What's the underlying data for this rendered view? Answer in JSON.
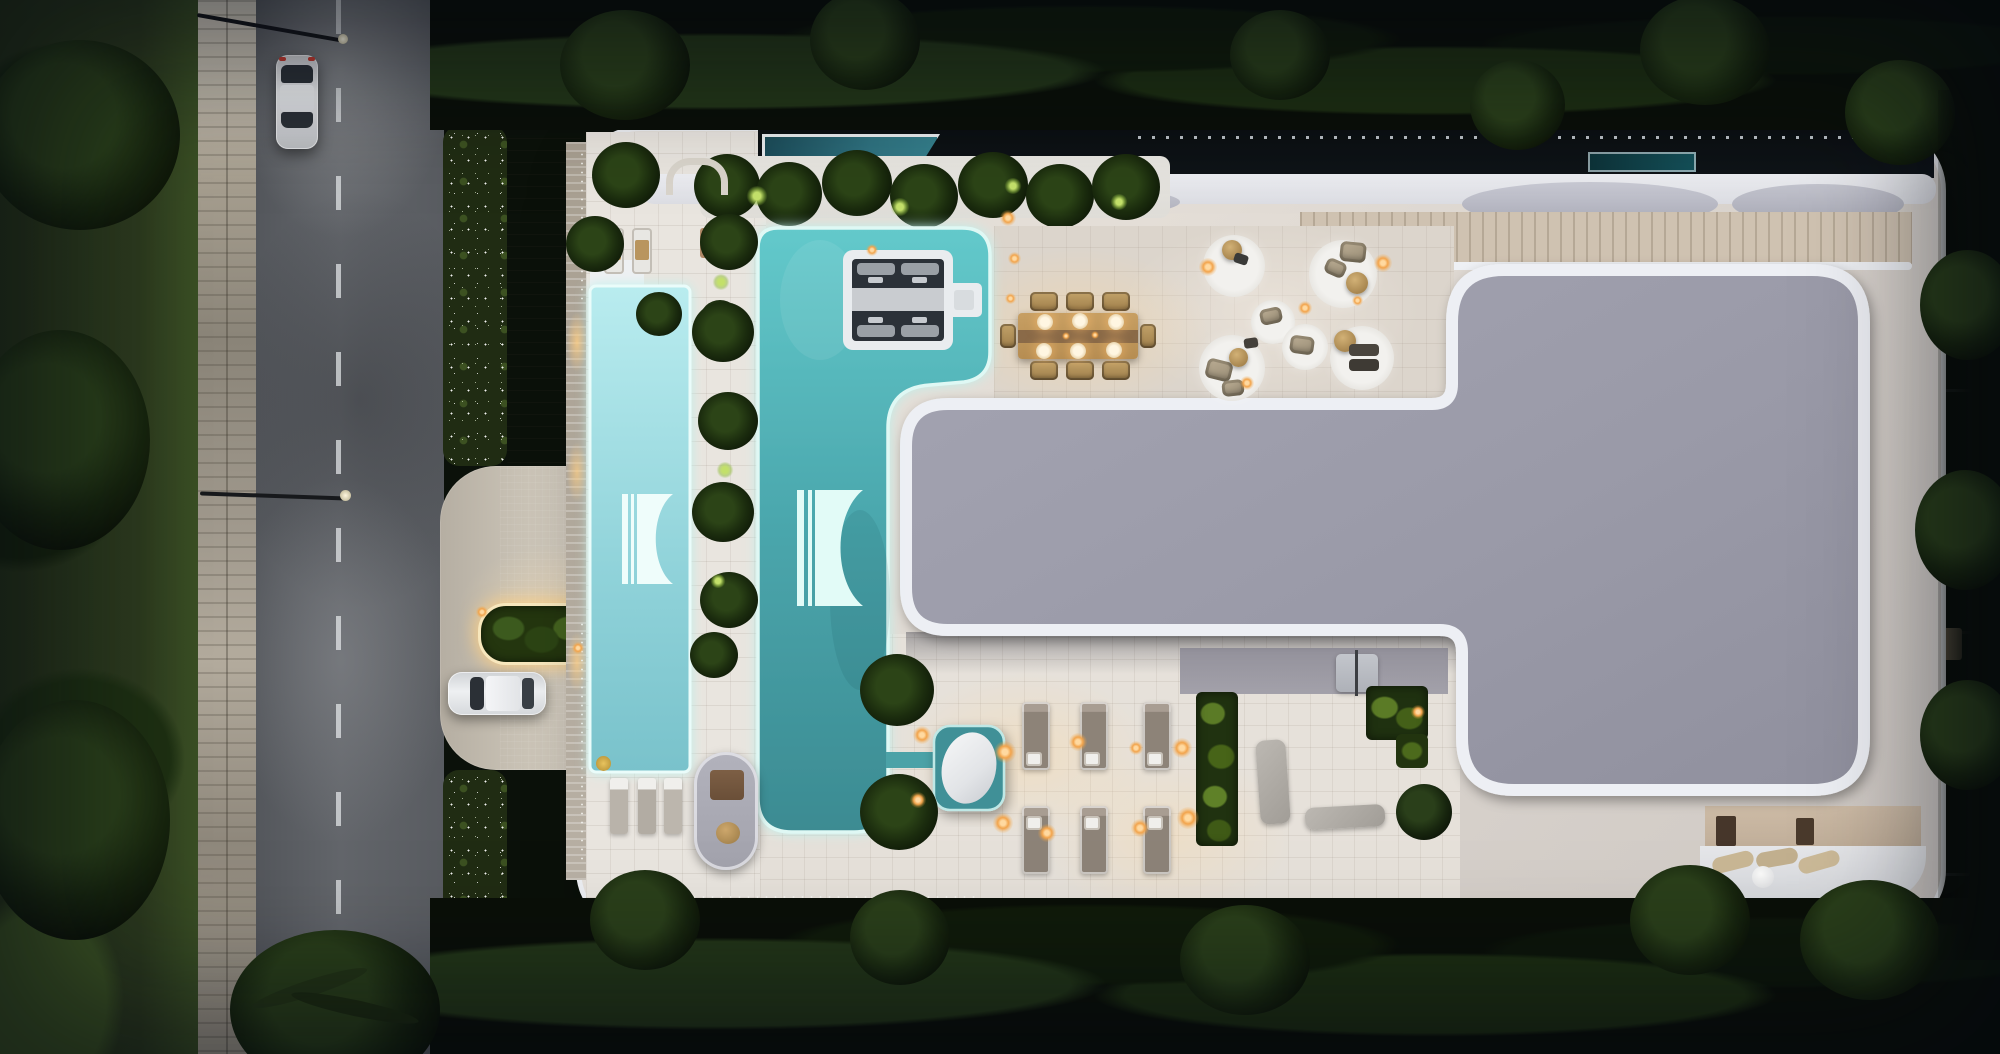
{
  "meta": {
    "title": "Dusk aerial top-down render of a modern luxury rooftop terrace",
    "render_type": "architectural-visualization",
    "time_of_day": "dusk",
    "view": "top-down"
  },
  "palette": {
    "veg_dark": "#0b110a",
    "veg_mid": "#1c2a14",
    "grass": "#2c3a1e",
    "leaf_lit": "#a8cc52",
    "road": "#5d6066",
    "sidewalk": "#b5afa2",
    "driveway": "#cbc4b7",
    "shell": "#d9d3cd",
    "rim": "#edeff3",
    "tile": "#e9e5df",
    "deck_warm": "#dcd5cc",
    "roof": "#9c9caa",
    "roof_edge": "#eef0f4",
    "dark_band": "#0f1418",
    "water_light": "#9edce2",
    "water_main": "#4fb3b9",
    "water_deep": "#3a868d",
    "water_glow": "#c9f4ef",
    "spa_dark": "#2b3138",
    "wood": "#c79f63",
    "wood_dark": "#8a6a48",
    "taupe": "#8d8378",
    "amber": "#f2a44c",
    "amber_soft": "#ffd9a0",
    "car_silver": "#d7d8da",
    "car_white": "#edeff1",
    "glass": "#2b3036",
    "marble": "#eef0f3"
  },
  "scene": {
    "setting": "Dusk aerial top-down view of a modern white-rimmed rooftop terrace with glowing pools, beside a tree-lined street",
    "street": {
      "road": "vertical asphalt road with dashed center line",
      "sidewalk": "plank-paved sidewalk under warm street light",
      "cars": [
        "silver sedan driving on road (top)",
        "white sedan parked at entry drive"
      ],
      "street_lamps": 2,
      "flower_hedges": "hedges dotted with white flowers along the road",
      "entry_planter": "pill-shaped planter with glowing light trim at the driveway"
    },
    "building": {
      "shape": "organic rounded rooftop shell with white rim and perforated edges",
      "roof": "large gray T-shaped roof slab with thick white rim",
      "pools": [
        "narrow glowing light-cyan perimeter pool with brand logo",
        "large L-shaped turquoise pool with brand logo and glowing edge",
        "sunken spa inset with four in-water loungers",
        "teal plunge tub with white marble boulder, linked to main pool"
      ],
      "logo_shape": "two vertical bars beside a square with a crescent bite cut from its right edge",
      "amenities": [
        "wooden dining table for eight with candle lights",
        "lounge circles with beige armchairs, round wood tables and string lights",
        "six taupe sun loungers in two rows",
        "stone benches, round bush and uplit planters on south terrace",
        "two loungers and pergola nook on northwest terrace",
        "rounded balcony pod with bench on southwest edge"
      ],
      "north_strip": "dark service band with small blue pool, lap pool, fence and gray canopies",
      "balconies": "white balcony strip along the right edge",
      "lower_terrace": "southeast lower terrace with loungers and round table"
    },
    "lighting": "warm amber path lights, glowing pool rims, uplit palms, candle-lit dining",
    "vegetation": "dense dark tree canopy surrounding the property, palms on deck"
  }
}
